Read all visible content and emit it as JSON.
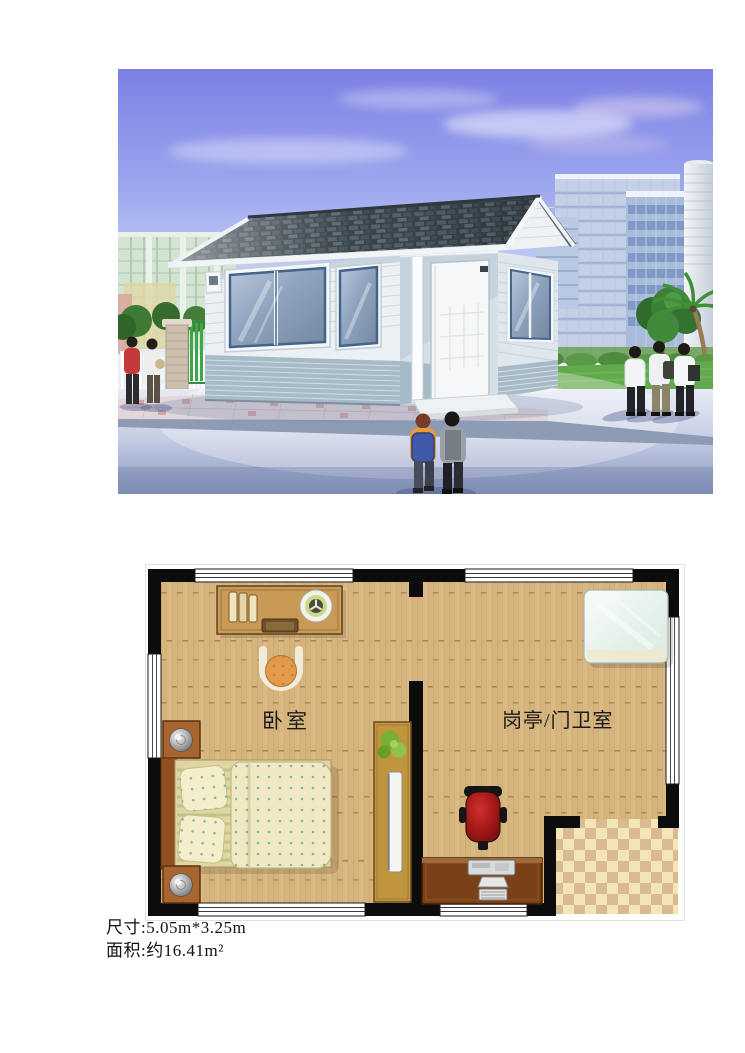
{
  "rendering": {
    "alt": "3D exterior rendering of a small prefabricated guard booth with a gray shingle gable roof, light horizontal-siding walls, blue-gray brick wainscot, blue-framed sliding windows and a white entry door; campus buildings, trees, a white fence and pedestrians surround it",
    "colors": {
      "sky_top": "#7b80e4",
      "roof_shingle": "#4a565c",
      "siding": "#eaf0f4",
      "wainscot": "#a6bac8",
      "window_glass": "#8fa8c8",
      "lawn": "#63a94f",
      "pavement": "#aab6d4"
    }
  },
  "floor_plan": {
    "rooms": [
      {
        "id": "bedroom",
        "label": "卧室"
      },
      {
        "id": "guard-room",
        "label": "岗亭/门卫室"
      }
    ],
    "furniture": [
      "dresser-desk",
      "stool",
      "double-bed",
      "nightstand-top",
      "nightstand-bottom",
      "wardrobe-with-plant",
      "sleeping-pad",
      "office-chair",
      "computer-desk"
    ],
    "colors": {
      "wall": "#0c0c0c",
      "wood_floor": "#d6b47e",
      "tile_light": "#f4e5b4",
      "tile_dark": "#d9ba92",
      "office_chair_red": "#a31818",
      "bed_linen": "#f0e9c4"
    }
  },
  "caption": {
    "dimensions": "尺寸:5.05m*3.25m",
    "area": "面积:约16.41m²"
  }
}
